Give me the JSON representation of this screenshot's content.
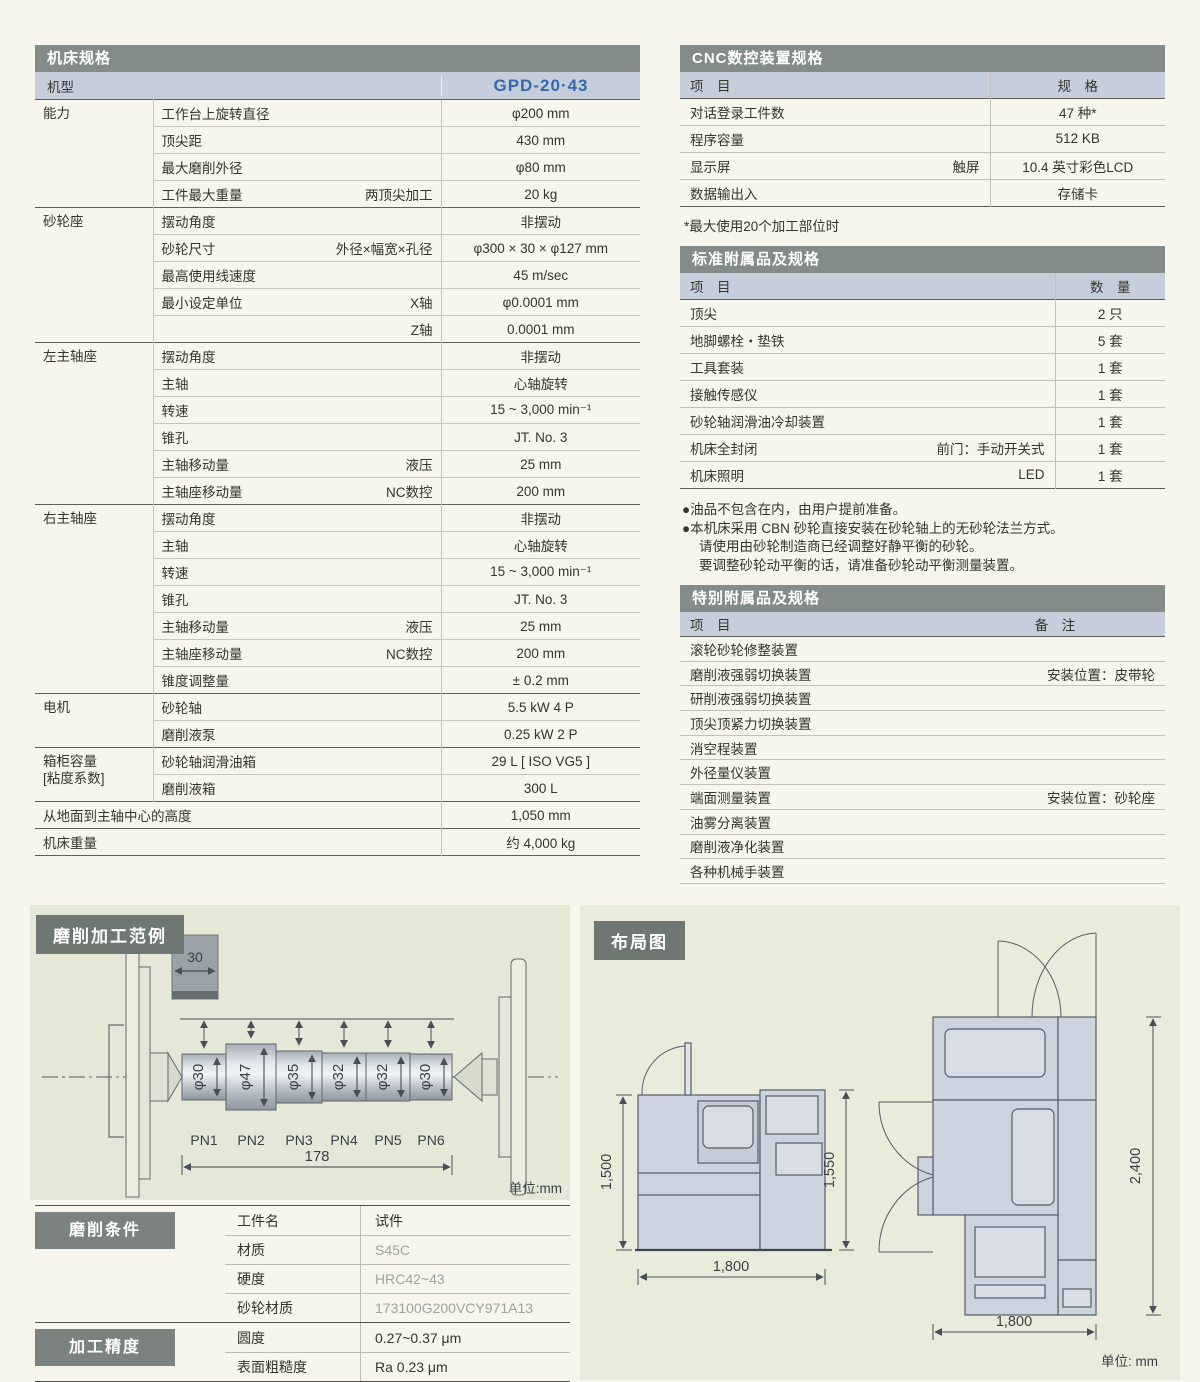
{
  "colors": {
    "accent_blue": "#3468b0",
    "bar_gray": "#848c8a",
    "row_blue": "#c7cedb",
    "panel_green": "#e5e8d6"
  },
  "machine_spec": {
    "title": "机床规格",
    "model_label": "机型",
    "model_value": "GPD-20·43",
    "groups": [
      {
        "category": "能力",
        "rows": [
          {
            "item": "工作台上旋转直径",
            "sub": "",
            "value": "φ200 mm"
          },
          {
            "item": "顶尖距",
            "sub": "",
            "value": "430 mm"
          },
          {
            "item": "最大磨削外径",
            "sub": "",
            "value": "φ80 mm"
          },
          {
            "item": "工件最大重量",
            "sub": "两顶尖加工",
            "value": "20 kg"
          }
        ]
      },
      {
        "category": "砂轮座",
        "rows": [
          {
            "item": "摆动角度",
            "sub": "",
            "value": "非摆动"
          },
          {
            "item": "砂轮尺寸",
            "sub": "外径×幅宽×孔径",
            "value": "φ300 × 30 × φ127 mm"
          },
          {
            "item": "最高使用线速度",
            "sub": "",
            "value": "45 m/sec"
          },
          {
            "item": "最小设定单位",
            "sub": "X轴",
            "value": "φ0.0001 mm"
          },
          {
            "item": "",
            "sub": "Z轴",
            "value": "0.0001 mm"
          }
        ]
      },
      {
        "category": "左主轴座",
        "rows": [
          {
            "item": "摆动角度",
            "sub": "",
            "value": "非摆动"
          },
          {
            "item": "主轴",
            "sub": "",
            "value": "心轴旋转"
          },
          {
            "item": "转速",
            "sub": "",
            "value": "15 ~ 3,000 min⁻¹"
          },
          {
            "item": "锥孔",
            "sub": "",
            "value": "JT. No. 3"
          },
          {
            "item": "主轴移动量",
            "sub": "液压",
            "value": "25 mm"
          },
          {
            "item": "主轴座移动量",
            "sub": "NC数控",
            "value": "200 mm"
          }
        ]
      },
      {
        "category": "右主轴座",
        "rows": [
          {
            "item": "摆动角度",
            "sub": "",
            "value": "非摆动"
          },
          {
            "item": "主轴",
            "sub": "",
            "value": "心轴旋转"
          },
          {
            "item": "转速",
            "sub": "",
            "value": "15 ~ 3,000 min⁻¹"
          },
          {
            "item": "锥孔",
            "sub": "",
            "value": "JT. No. 3"
          },
          {
            "item": "主轴移动量",
            "sub": "液压",
            "value": "25 mm"
          },
          {
            "item": "主轴座移动量",
            "sub": "NC数控",
            "value": "200 mm"
          },
          {
            "item": "锥度调整量",
            "sub": "",
            "value": "± 0.2 mm"
          }
        ]
      },
      {
        "category": "电机",
        "rows": [
          {
            "item": "砂轮轴",
            "sub": "",
            "value": "5.5 kW  4 P"
          },
          {
            "item": "磨削液泵",
            "sub": "",
            "value": "0.25 kW 2 P"
          }
        ]
      },
      {
        "category": "箱柜容量",
        "category2": "[粘度系数]",
        "rows": [
          {
            "item": "砂轮轴润滑油箱",
            "sub": "",
            "value": "29 L [ ISO VG5 ]"
          },
          {
            "item": "磨削液箱",
            "sub": "",
            "value": "300 L"
          }
        ]
      }
    ],
    "footer_rows": [
      {
        "item": "从地面到主轴中心的高度",
        "value": "1,050 mm"
      },
      {
        "item": "机床重量",
        "value": "约 4,000 kg"
      }
    ]
  },
  "cnc_spec": {
    "title": "CNC数控装置规格",
    "col_item": "项　目",
    "col_value": "规　格",
    "rows": [
      {
        "item": "对话登录工件数",
        "sub": "",
        "value": "47 种*"
      },
      {
        "item": "程序容量",
        "sub": "",
        "value": "512 KB"
      },
      {
        "item": "显示屏",
        "sub": "触屏",
        "value": "10.4 英寸彩色LCD"
      },
      {
        "item": "数据输出入",
        "sub": "",
        "value": "存储卡"
      }
    ],
    "footnote": "*最大使用20个加工部位时"
  },
  "standard_accessories": {
    "title": "标准附属品及规格",
    "col_item": "项　目",
    "col_qty": "数　量",
    "rows": [
      {
        "item": "顶尖",
        "sub": "",
        "qty": "2 只"
      },
      {
        "item": "地脚螺栓・垫铁",
        "sub": "",
        "qty": "5 套"
      },
      {
        "item": "工具套装",
        "sub": "",
        "qty": "1 套"
      },
      {
        "item": "接触传感仪",
        "sub": "",
        "qty": "1 套"
      },
      {
        "item": "砂轮轴润滑油冷却装置",
        "sub": "",
        "qty": "1 套"
      },
      {
        "item": "机床全封闭",
        "sub": "前门：手动开关式",
        "qty": "1 套"
      },
      {
        "item": "机床照明",
        "sub": "LED",
        "qty": "1 套"
      }
    ]
  },
  "notes": {
    "lines": [
      "●油品不包含在内，由用户提前准备。",
      "●本机床采用 CBN 砂轮直接安装在砂轮轴上的无砂轮法兰方式。",
      "请使用由砂轮制造商已经调整好静平衡的砂轮。",
      "要调整砂轮动平衡的话，请准备砂轮动平衡测量装置。"
    ]
  },
  "special_accessories": {
    "title": "特别附属品及规格",
    "col_item": "项　目",
    "col_note": "备　注",
    "rows": [
      {
        "item": "滚轮砂轮修整装置",
        "note": ""
      },
      {
        "item": "磨削液强弱切换装置",
        "note": "安装位置：皮带轮"
      },
      {
        "item": "研削液强弱切换装置",
        "note": ""
      },
      {
        "item": "顶尖顶紧力切换装置",
        "note": ""
      },
      {
        "item": "消空程装置",
        "note": ""
      },
      {
        "item": "外径量仪装置",
        "note": ""
      },
      {
        "item": "端面测量装置",
        "note": "安装位置：砂轮座"
      },
      {
        "item": "油雾分离装置",
        "note": ""
      },
      {
        "item": "磨削液净化装置",
        "note": ""
      },
      {
        "item": "各种机械手装置",
        "note": ""
      }
    ]
  },
  "grinding_example": {
    "title": "磨削加工范例",
    "wheel_width": "30",
    "sections": [
      {
        "label": "PN1",
        "dia": "φ30"
      },
      {
        "label": "PN2",
        "dia": "φ47"
      },
      {
        "label": "PN3",
        "dia": "φ35"
      },
      {
        "label": "PN4",
        "dia": "φ32"
      },
      {
        "label": "PN5",
        "dia": "φ32"
      },
      {
        "label": "PN6",
        "dia": "φ30"
      }
    ],
    "total_length": "178",
    "unit": "单位:mm"
  },
  "grinding_conditions": {
    "title": "磨削条件",
    "rows": [
      {
        "item": "工件名",
        "value": "试件"
      },
      {
        "item": "材质",
        "value": "S45C"
      },
      {
        "item": "硬度",
        "value": "HRC42~43"
      },
      {
        "item": "砂轮材质",
        "value": "173100G200VCY971A13"
      }
    ]
  },
  "accuracy": {
    "title": "加工精度",
    "rows": [
      {
        "item": "圆度",
        "value": "0.27~0.37 μm"
      },
      {
        "item": "表面粗糙度",
        "value": "Ra 0.23 μm"
      }
    ]
  },
  "layout_diagram": {
    "title": "布局图",
    "front": {
      "height_left": "1,500",
      "height_right": "1,550",
      "width": "1,800"
    },
    "plan": {
      "depth": "2,400",
      "width": "1,800"
    },
    "unit": "单位: mm"
  }
}
